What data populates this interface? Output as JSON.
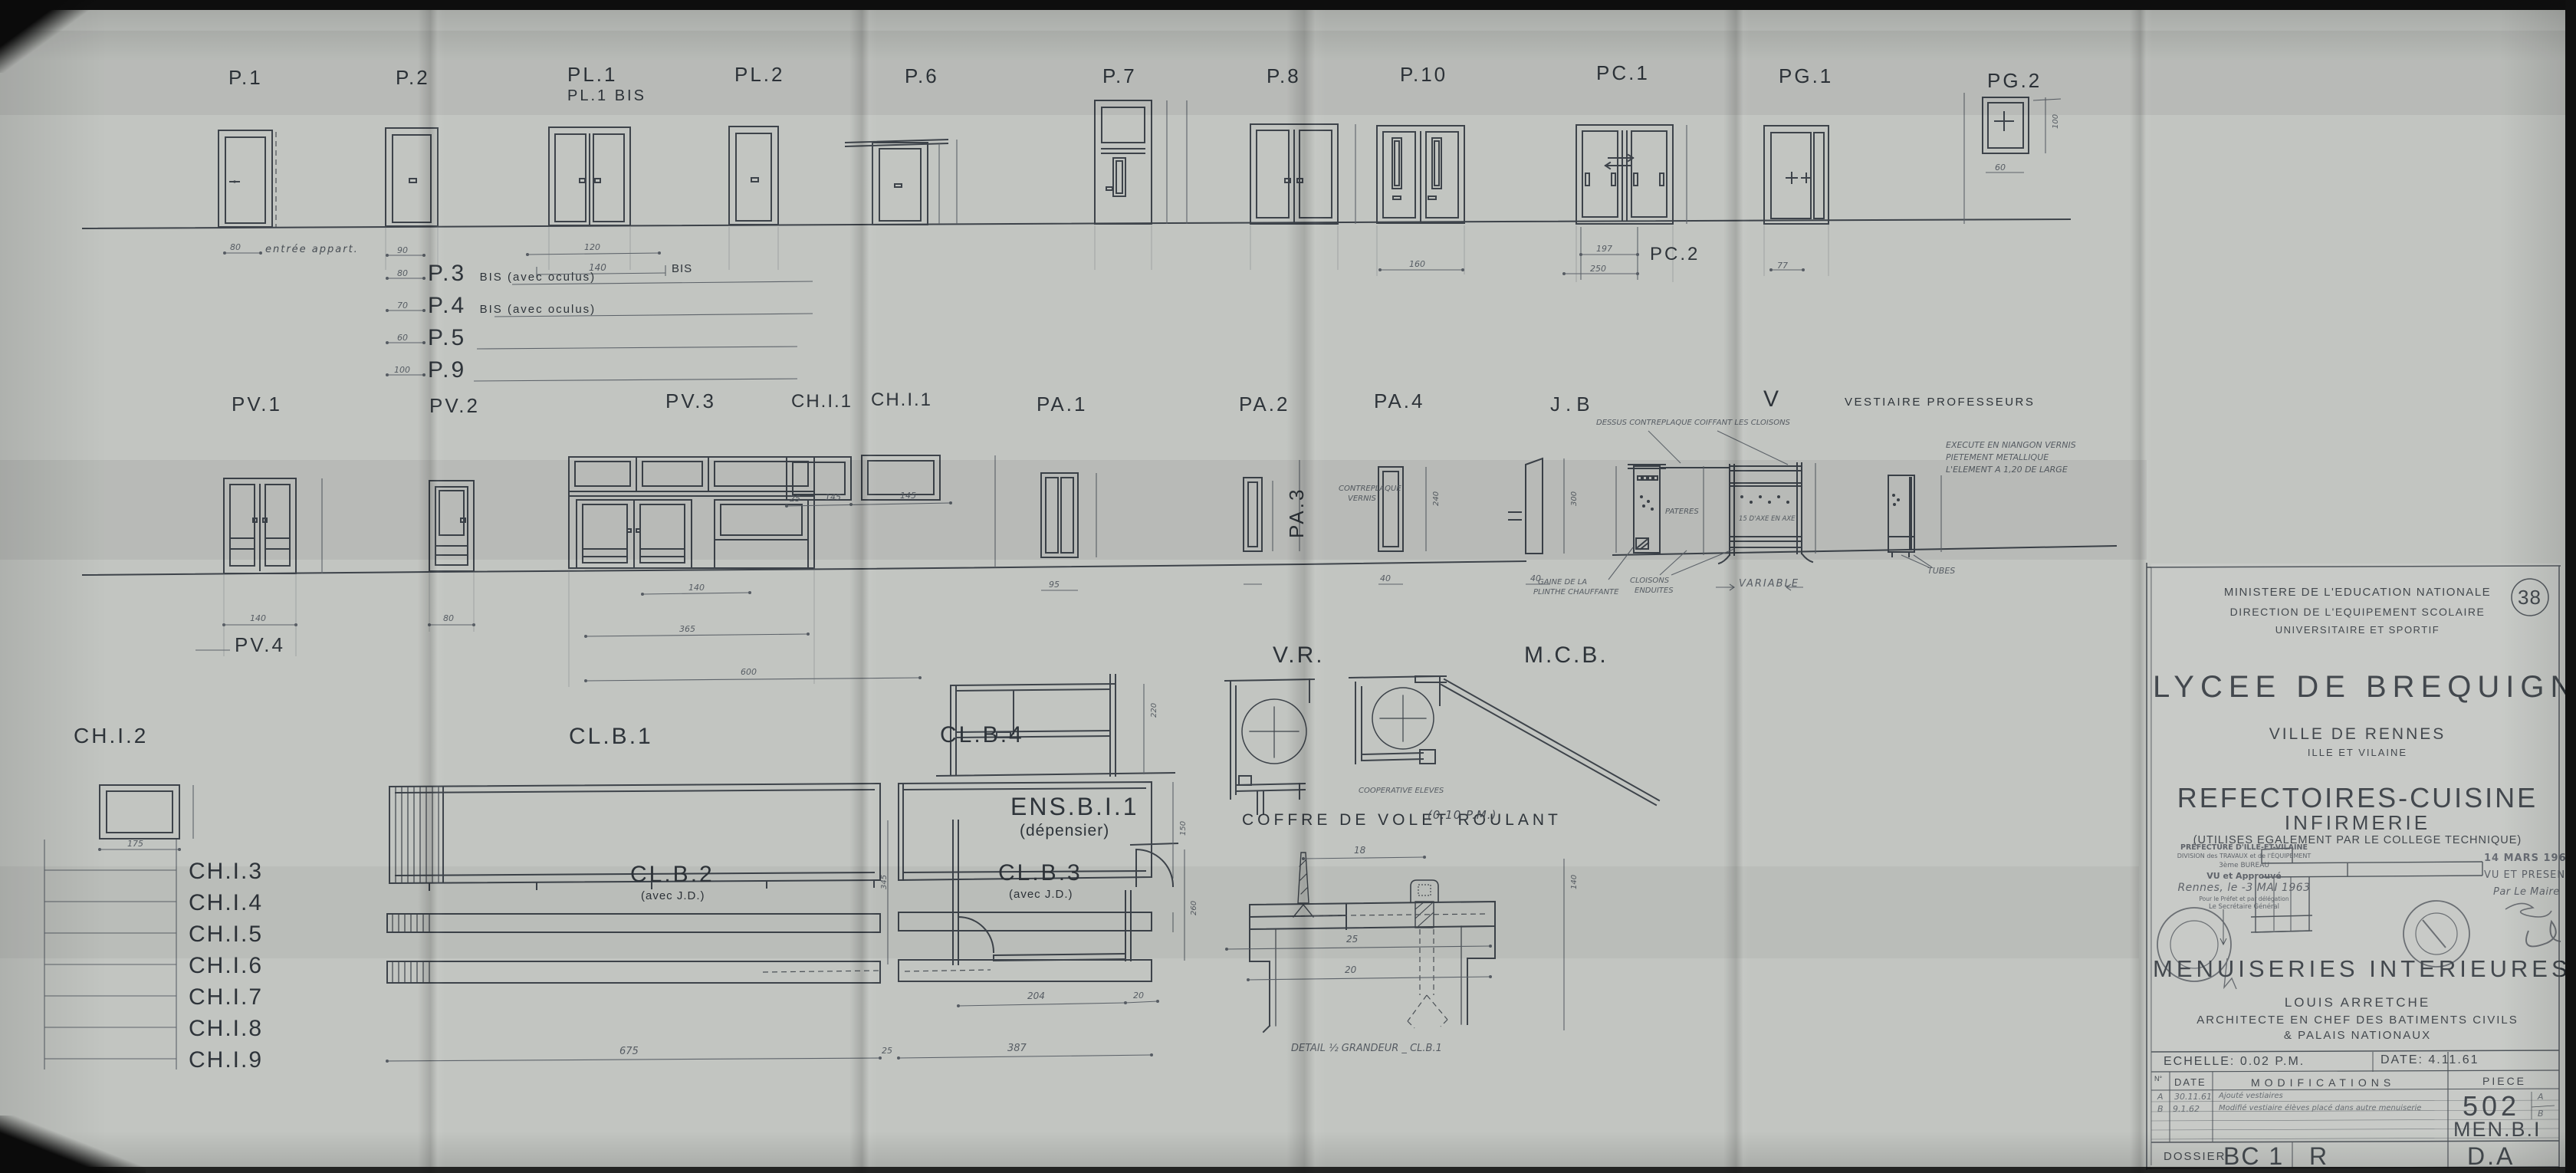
{
  "colors": {
    "paper": "#c2c5c1",
    "ink": "#2e343a",
    "line": "#3d434a",
    "dim": "#565c63"
  },
  "sheet": {
    "number": "38"
  },
  "top_row": {
    "p1": "P.1",
    "p2": "P.2",
    "pl1": "PL.1",
    "pl1_bis": "PL.1 BIS",
    "pl2": "PL.2",
    "p6": "P.6",
    "p7": "P.7",
    "p8": "P.8",
    "p10": "P.10",
    "pc1": "PC.1",
    "pc2": "PC.2",
    "pg1": "PG.1",
    "pg2": "PG.2",
    "entree_note": "entrée appart.",
    "variants": [
      {
        "name": "P.3",
        "suffix": "BIS (avec oculus)"
      },
      {
        "name": "P.4",
        "suffix": "BIS (avec oculus)"
      },
      {
        "name": "P.5",
        "suffix": ""
      },
      {
        "name": "P.9",
        "suffix": ""
      }
    ],
    "bis_tag": "BIS"
  },
  "middle_row": {
    "pv1": "PV.1",
    "pv2": "PV.2",
    "pv3": "PV.3",
    "pv4": "PV.4",
    "chi1_a": "CH.I.1",
    "chi1_b": "CH.I.1",
    "pa1": "PA.1",
    "pa2": "PA.2",
    "pa3": "PA.3",
    "pa4": "PA.4",
    "jb": "J.B",
    "v": "V",
    "vestiaire": "VESTIAIRE PROFESSEURS",
    "annotations": {
      "dessus": "DESSUS CONTREPLAQUE COIFFANT LES CLOISONS",
      "contreplaque_1": "CONTREPLAQUE",
      "contreplaque_2": "VERNIS",
      "pateres": "PATERES",
      "axe": "15 D'AXE EN AXE",
      "gaine_1": "GAINE DE LA",
      "gaine_2": "PLINTHE CHAUFFANTE",
      "cloisons_1": "CLOISONS",
      "cloisons_2": "ENDUITES",
      "variable": "VARIABLE",
      "execute_1": "EXECUTE EN NIANGON VERNIS",
      "execute_2": "PIETEMENT METALLIQUE",
      "execute_3": "L'ELEMENT A 1,20 DE LARGE",
      "tubes": "TUBES"
    }
  },
  "bottom_row": {
    "chi2": "CH.I.2",
    "chi_list": [
      "CH.I.3",
      "CH.I.4",
      "CH.I.5",
      "CH.I.6",
      "CH.I.7",
      "CH.I.8",
      "CH.I.9"
    ],
    "clb1": "CL.B.1",
    "clb4": "CL.B.4",
    "clb2": "CL.B.2",
    "clb3": "CL.B.3",
    "avec_jd": "(avec J.D.)",
    "ens": "ENS.B.I.1",
    "ens_sub": "(dépensier)",
    "vr": "V.R.",
    "mcb": "M.C.B.",
    "coop": "COOPERATIVE ELEVES",
    "coffre": "COFFRE DE VOLET ROULANT",
    "coffre_scale": "(0.10 P.M.)",
    "detail_caption": "DETAIL ½ GRANDEUR _ CL.B.1"
  },
  "dims": {
    "d18": "18",
    "d20": "20",
    "d25": "25",
    "d40": "40",
    "d60": "60",
    "d77": "77",
    "d80": "80",
    "d90": "90",
    "d95": "95",
    "d100": "100",
    "d120": "120",
    "d140": "140",
    "d145": "145",
    "d150": "150",
    "d160": "160",
    "d175": "175",
    "d197": "197",
    "d204": "204",
    "d220": "220",
    "d240": "240",
    "d250": "250",
    "d260": "260",
    "d300": "300",
    "d345": "345",
    "d365": "365",
    "d387": "387",
    "d600": "600",
    "d675": "675"
  },
  "title_block": {
    "ministry_1": "MINISTERE DE L'EDUCATION NATIONALE",
    "ministry_2": "DIRECTION DE L'EQUIPEMENT SCOLAIRE",
    "ministry_3": "UNIVERSITAIRE ET SPORTIF",
    "project": "LYCEE DE BREQUIGNY",
    "city": "VILLE DE RENNES",
    "department": "ILLE ET VILAINE",
    "subject_1": "REFECTOIRES-CUISINE",
    "subject_2": "INFIRMERIE",
    "subject_note": "(UTILISES EGALEMENT PAR LE COLLEGE TECHNIQUE)",
    "drawing_title": "MENUISERIES INTERIEURES BOIS",
    "architect": "LOUIS ARRETCHE",
    "architect_title_1": "ARCHITECTE EN CHEF DES BATIMENTS CIVILS",
    "architect_title_2": "& PALAIS NATIONAUX",
    "scale": "ECHELLE: 0.02 P.M.",
    "date": "DATE: 4.11.61",
    "col_no": "N°",
    "col_date": "DATE",
    "col_modifications": "MODIFICATIONS",
    "col_piece": "PIECE",
    "mods": [
      {
        "id": "A",
        "date": "30.11.61",
        "text": "Ajouté vestiaires"
      },
      {
        "id": "B",
        "date": "9.1.62",
        "text": "Modifié vestiaire élèves placé dans autre menuiserie"
      }
    ],
    "piece_number": "502",
    "piece_rev_a": "A",
    "piece_rev_b": "B",
    "piece_code": "MEN.B.I",
    "dossier_label": "DOSSIER",
    "dossier_value": "BC 1",
    "dossier_rev": "R",
    "dossier_code": "D.A",
    "stamp_prefecture": [
      "PRÉFECTURE D'ILLE-ET-VILAINE",
      "DIVISION des TRAVAUX et de l'ÉQUIPEMENT",
      "3ème BUREAU",
      "VU et Approuvé",
      "Rennes, le  -3 MAI 1963",
      "Pour le Préfet et par délégation",
      "Le Secrétaire Général"
    ],
    "stamp_mayor": [
      "14 MARS 1963",
      "VU ET PRESENTE",
      "Par Le Maire"
    ]
  }
}
